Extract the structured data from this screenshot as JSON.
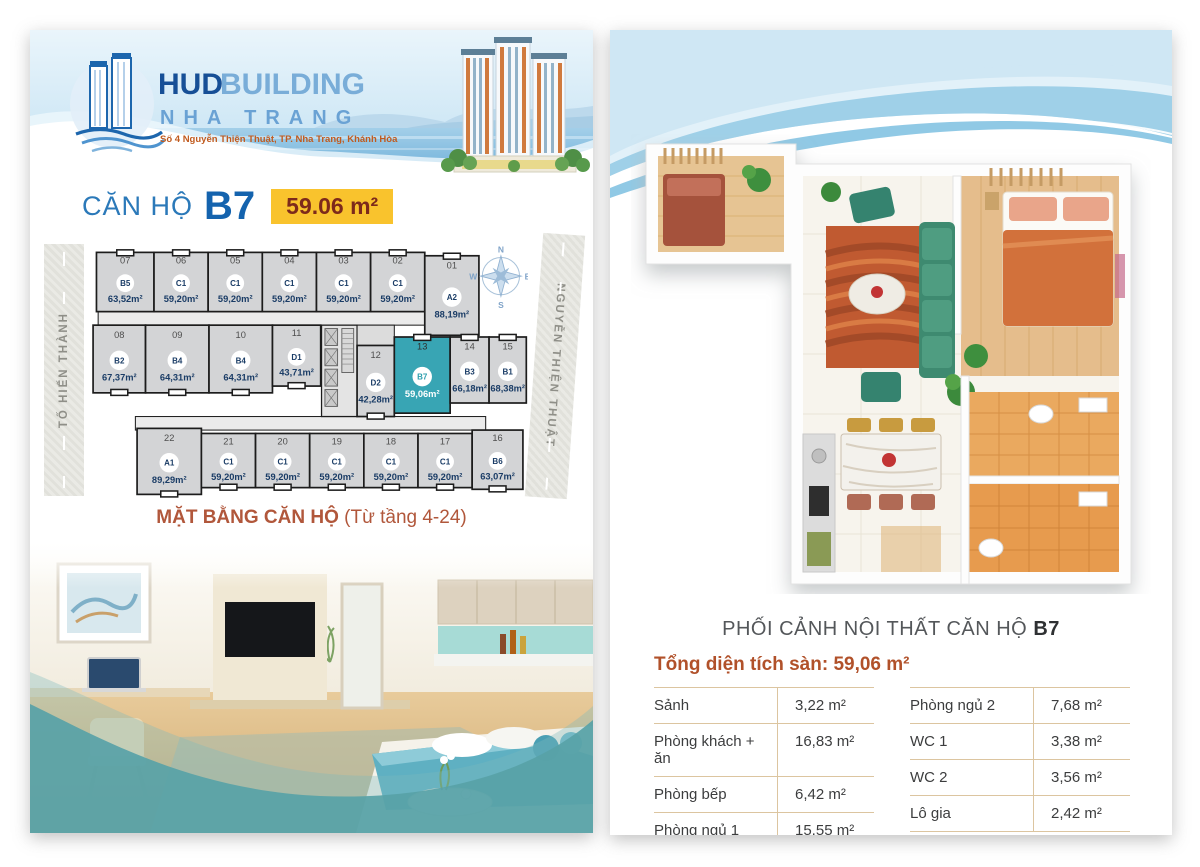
{
  "page_left": {
    "header": {
      "brand_primary": "HUD",
      "brand_secondary": "BUILDING",
      "brand_city": "NHA TRANG",
      "address": "Số 4 Nguyễn Thiện Thuật, TP. Nha Trang, Khánh Hòa"
    },
    "title": {
      "prefix": "CĂN HỘ",
      "unit_code": "B7",
      "area_badge": "59.06 m²",
      "badge_bg": "#f9c32d",
      "accent_blue": "#1463ae"
    },
    "floorplan": {
      "street_left": "TỐ HIẾN THÀNH",
      "street_right": "NGUYỄN THIỆN THUẬT",
      "compass": {
        "n": "N",
        "e": "E",
        "s": "S",
        "w": "W"
      },
      "highlight_color": "#38a5b4",
      "rows": [
        [
          {
            "no": "07",
            "type": "B5",
            "area": "63,52m²"
          },
          {
            "no": "06",
            "type": "C1",
            "area": "59,20m²"
          },
          {
            "no": "05",
            "type": "C1",
            "area": "59,20m²"
          },
          {
            "no": "04",
            "type": "C1",
            "area": "59,20m²"
          },
          {
            "no": "03",
            "type": "C1",
            "area": "59,20m²"
          },
          {
            "no": "02",
            "type": "C1",
            "area": "59,20m²"
          },
          {
            "no": "01",
            "type": "A2",
            "area": "88,19m²"
          }
        ],
        [
          {
            "no": "08",
            "type": "B2",
            "area": "67,37m²"
          },
          {
            "no": "09",
            "type": "B4",
            "area": "64,31m²"
          },
          {
            "no": "10",
            "type": "B4",
            "area": "64,31m²"
          },
          {
            "no": "11",
            "type": "D1",
            "area": "43,71m²"
          },
          {
            "no": "12",
            "type": "D2",
            "area": "42,28m²"
          },
          {
            "no": "13",
            "type": "B7",
            "area": "59,06m²",
            "highlight": true
          },
          {
            "no": "14",
            "type": "B3",
            "area": "66,18m²"
          },
          {
            "no": "15",
            "type": "B1",
            "area": "68,38m²"
          }
        ],
        [
          {
            "no": "22",
            "type": "A1",
            "area": "89,29m²"
          },
          {
            "no": "21",
            "type": "C1",
            "area": "59,20m²"
          },
          {
            "no": "20",
            "type": "C1",
            "area": "59,20m²"
          },
          {
            "no": "19",
            "type": "C1",
            "area": "59,20m²"
          },
          {
            "no": "18",
            "type": "C1",
            "area": "59,20m²"
          },
          {
            "no": "17",
            "type": "C1",
            "area": "59,20m²"
          },
          {
            "no": "16",
            "type": "B6",
            "area": "63,07m²"
          }
        ]
      ],
      "caption": "MẶT BẰNG CĂN HỘ",
      "caption_note": "(Từ tầng 4-24)"
    }
  },
  "page_right": {
    "render_caption": {
      "text": "PHỐI CẢNH NỘI THẤT CĂN HỘ",
      "unit_code": "B7"
    },
    "area_table": {
      "title": "Tổng diện tích sàn: 59,06 m²",
      "left_rows": [
        {
          "label": "Sảnh",
          "value": "3,22 m²"
        },
        {
          "label": "Phòng khách + ăn",
          "value": "16,83 m²"
        },
        {
          "label": "Phòng bếp",
          "value": "6,42 m²"
        },
        {
          "label": "Phòng ngủ 1",
          "value": "15,55 m²"
        }
      ],
      "right_rows": [
        {
          "label": "Phòng ngủ 2",
          "value": "7,68 m²"
        },
        {
          "label": "WC 1",
          "value": "3,38 m²"
        },
        {
          "label": "WC 2",
          "value": "3,56 m²"
        },
        {
          "label": "Lô gia",
          "value": "2,42 m²"
        }
      ]
    }
  }
}
